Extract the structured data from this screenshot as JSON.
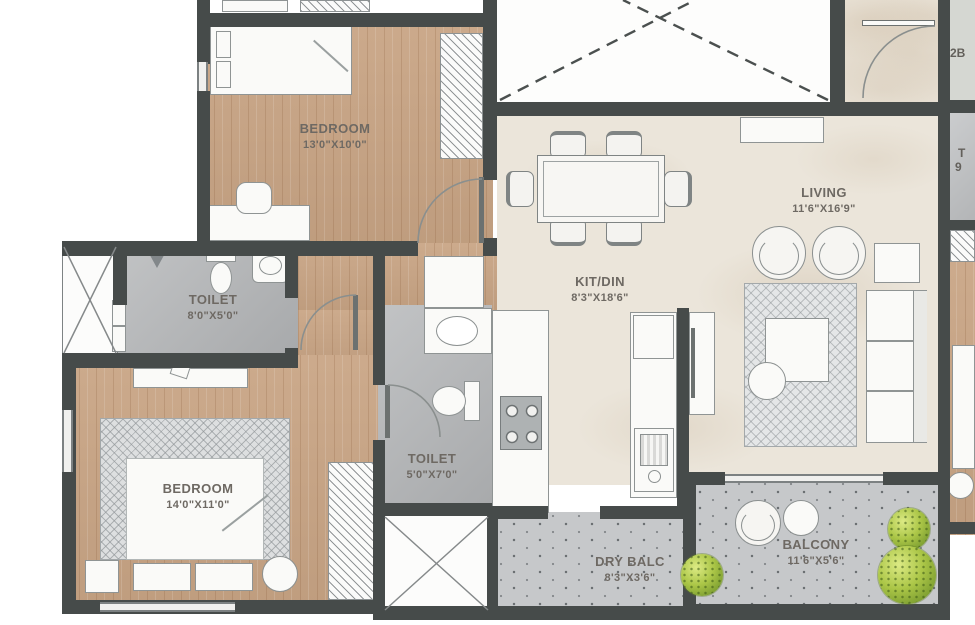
{
  "plan": {
    "rooms": [
      {
        "name": "BEDROOM",
        "dims": "13'0\"X10'0\""
      },
      {
        "name": "TOILET",
        "dims": "8'0\"X5'0\""
      },
      {
        "name": "BEDROOM",
        "dims": "14'0\"X11'0\""
      },
      {
        "name": "TOILET",
        "dims": "5'0\"X7'0\""
      },
      {
        "name": "KIT/DIN",
        "dims": "8'3\"X18'6\""
      },
      {
        "name": "LIVING",
        "dims": "11'6\"X16'9\""
      },
      {
        "name": "DRY BALC",
        "dims": "8'3\"X3'6\""
      },
      {
        "name": "BALCONY",
        "dims": "11'6\"X5'6\""
      }
    ],
    "edge_texts": {
      "top_right": "2B",
      "mid_right_line1": "T",
      "mid_right_line2": "9"
    },
    "colors": {
      "wall": "#464b4a",
      "wood": "#c9a585",
      "marble": "#ebe5da",
      "tile": "#b4b6b8",
      "balcony_tile": "#c6c8ca",
      "plant": "#abc647"
    }
  }
}
